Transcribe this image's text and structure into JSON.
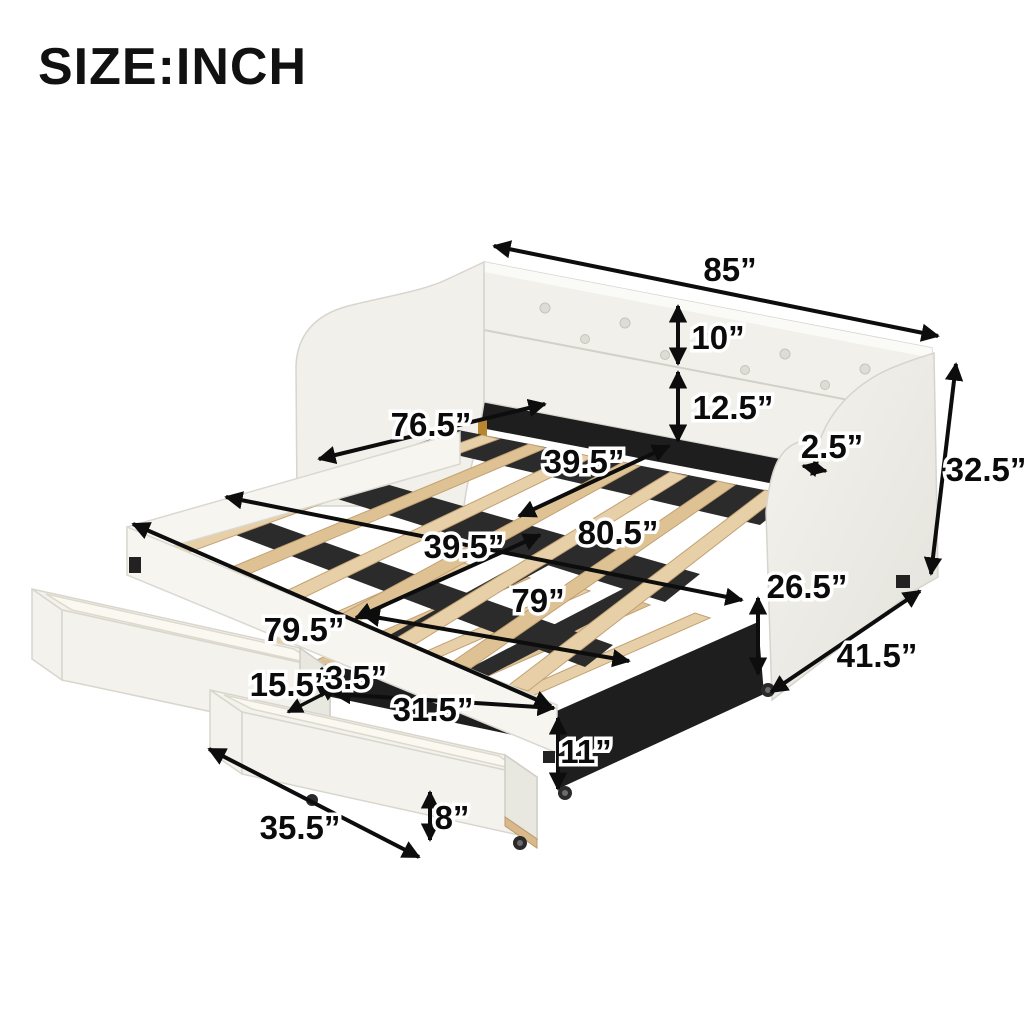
{
  "title": "SIZE:INCH",
  "colors": {
    "background": "#ffffff",
    "line": "#0d0d0d",
    "upholstery": "#f1f0ea",
    "wood_slat": "#e7cfa8",
    "metal_frame": "#1e1e1e"
  },
  "dims": {
    "d85": {
      "label": "85”",
      "inches": 85,
      "measures": "overall length"
    },
    "d10": {
      "label": "10”",
      "inches": 10,
      "measures": "backrest cushion height"
    },
    "d12_5": {
      "label": "12.5”",
      "inches": 12.5,
      "measures": "backrest bottom to slat deck"
    },
    "d76_5": {
      "label": "76.5”",
      "inches": 76.5,
      "measures": "inner slat deck length"
    },
    "d39_5a": {
      "label": "39.5”",
      "inches": 39.5,
      "measures": "upper deck width"
    },
    "d2_5": {
      "label": "2.5”",
      "inches": 2.5,
      "measures": "arm thickness"
    },
    "d32_5": {
      "label": "32.5”",
      "inches": 32.5,
      "measures": "overall height"
    },
    "d80_5": {
      "label": "80.5”",
      "inches": 80.5,
      "measures": "frame length"
    },
    "d39_5b": {
      "label": "39.5”",
      "inches": 39.5,
      "measures": "trundle width"
    },
    "d26_5": {
      "label": "26.5”",
      "inches": 26.5,
      "measures": "arm front height"
    },
    "d79": {
      "label": "79”",
      "inches": 79,
      "measures": "trundle length"
    },
    "d79_5": {
      "label": "79.5”",
      "inches": 79.5,
      "measures": "front rail length"
    },
    "d41_5": {
      "label": "41.5”",
      "inches": 41.5,
      "measures": "overall depth"
    },
    "d15_5": {
      "label": "15.5”",
      "inches": 15.5,
      "measures": "drawer width"
    },
    "d3_5": {
      "label": "3.5”",
      "inches": 3.5,
      "measures": "drawer gap height"
    },
    "d31_5": {
      "label": "31.5”",
      "inches": 31.5,
      "measures": "drawer inner length"
    },
    "d11": {
      "label": "11”",
      "inches": 11,
      "measures": "trundle frame height"
    },
    "d35_5": {
      "label": "35.5”",
      "inches": 35.5,
      "measures": "drawer length"
    },
    "d8": {
      "label": "8”",
      "inches": 8,
      "measures": "drawer height"
    }
  }
}
